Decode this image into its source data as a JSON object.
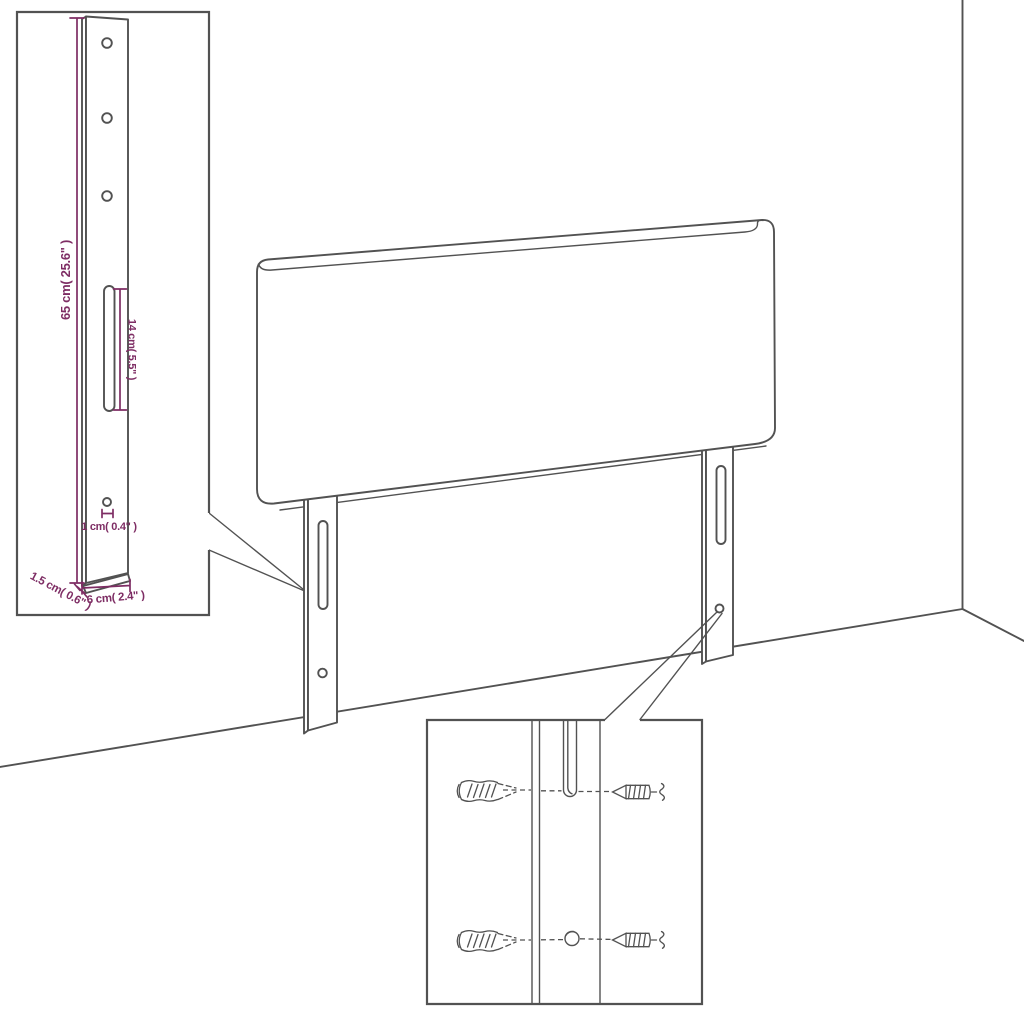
{
  "diagram": {
    "type": "furniture-assembly-dimension-diagram",
    "subject": "upholstered headboard with two mounting legs shown in a room corner",
    "colors": {
      "line": "#525252",
      "dimension": "#7e2d64",
      "background": "#ffffff"
    },
    "insets": {
      "leg_detail": {
        "dimensions": {
          "height": "65 cm( 25.6\" )",
          "slot_length": "14 cm( 5.5\" )",
          "hole": "1 cm( 0.4\" )",
          "depth": "1.5 cm( 0.6\" )",
          "width": "6 cm( 2.4\" )"
        }
      },
      "hardware_detail": {
        "parts": [
          "wall-plug-icon",
          "screw-icon"
        ]
      }
    }
  }
}
